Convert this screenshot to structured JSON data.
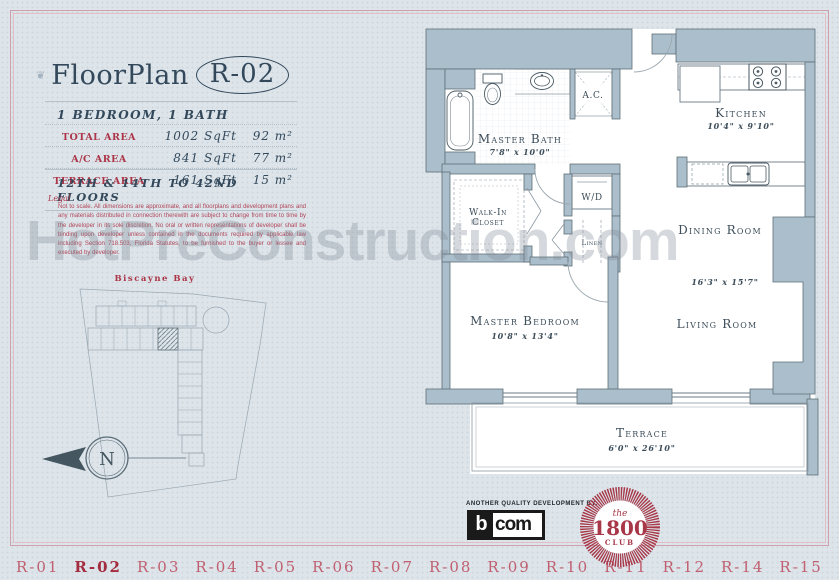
{
  "watermark": "HotPreConstruction.com",
  "header": {
    "ornament": "❦",
    "title": "FloorPlan",
    "plan_id": "R-02",
    "subtitle": "1 BEDROOM, 1 BATH"
  },
  "area_table": {
    "rows": [
      {
        "label": "TOTAL AREA",
        "sqft": "1002 SqFt",
        "metric": "92 m²"
      },
      {
        "label": "A/C AREA",
        "sqft": "841 SqFt",
        "metric": "77 m²"
      },
      {
        "label": "TERRACE AREA",
        "sqft": "161 SqFt",
        "metric": "15 m²"
      }
    ]
  },
  "floors_note": "12TH & 14TH TO 42ND FLOORS",
  "legal": {
    "label": "Legal",
    "text": "Not to scale. All dimensions are approximate, and all floorplans and development plans and any materials distributed in connection therewith are subject to change from time to time by the developer in its sole discretion. No oral or written representations of developer shall be binding upon developer unless contained in the documents required by applicable law including Section 718.503, Florida Statutes, to be furnished to the buyer or lessee and executed by developer."
  },
  "site_plan": {
    "bay_label": "Biscayne Bay",
    "compass_label": "N"
  },
  "floor_plan": {
    "rooms": {
      "master_bath": {
        "name": "Master Bath",
        "dims": "7'8\" x 10'0\""
      },
      "kitchen": {
        "name": "Kitchen",
        "dims": "10'4\" x 9'10\""
      },
      "walk_in_closet": {
        "line1": "Walk-In",
        "line2": "Closet"
      },
      "wd": {
        "name": "W/D"
      },
      "linen": {
        "name": "Linen"
      },
      "ac": {
        "name": "A.C."
      },
      "dining": {
        "name": "Dining Room",
        "dims": "16'3\" x 15'7\""
      },
      "master_bedroom": {
        "name": "Master Bedroom",
        "dims": "10'8\" x 13'4\""
      },
      "living": {
        "name": "Living Room"
      },
      "terrace": {
        "name": "Terrace",
        "dims": "6'0\" x 26'10\""
      }
    }
  },
  "footer": {
    "tagline": "ANOTHER QUALITY DEVELOPMENT BY:",
    "bcom": {
      "b": "b",
      "com": "com"
    },
    "club": {
      "the": "the",
      "year": "1800",
      "name": "CLUB"
    }
  },
  "nav": {
    "items": [
      {
        "label": "R-01",
        "active": false
      },
      {
        "label": "R-02",
        "active": true
      },
      {
        "label": "R-03",
        "active": false
      },
      {
        "label": "R-04",
        "active": false
      },
      {
        "label": "R-05",
        "active": false
      },
      {
        "label": "R-06",
        "active": false
      },
      {
        "label": "R-07",
        "active": false
      },
      {
        "label": "R-08",
        "active": false
      },
      {
        "label": "R-09",
        "active": false
      },
      {
        "label": "R-10",
        "active": false
      },
      {
        "label": "R-11",
        "active": false
      },
      {
        "label": "R-12",
        "active": false
      },
      {
        "label": "R-14",
        "active": false
      },
      {
        "label": "R-15",
        "active": false
      }
    ]
  }
}
